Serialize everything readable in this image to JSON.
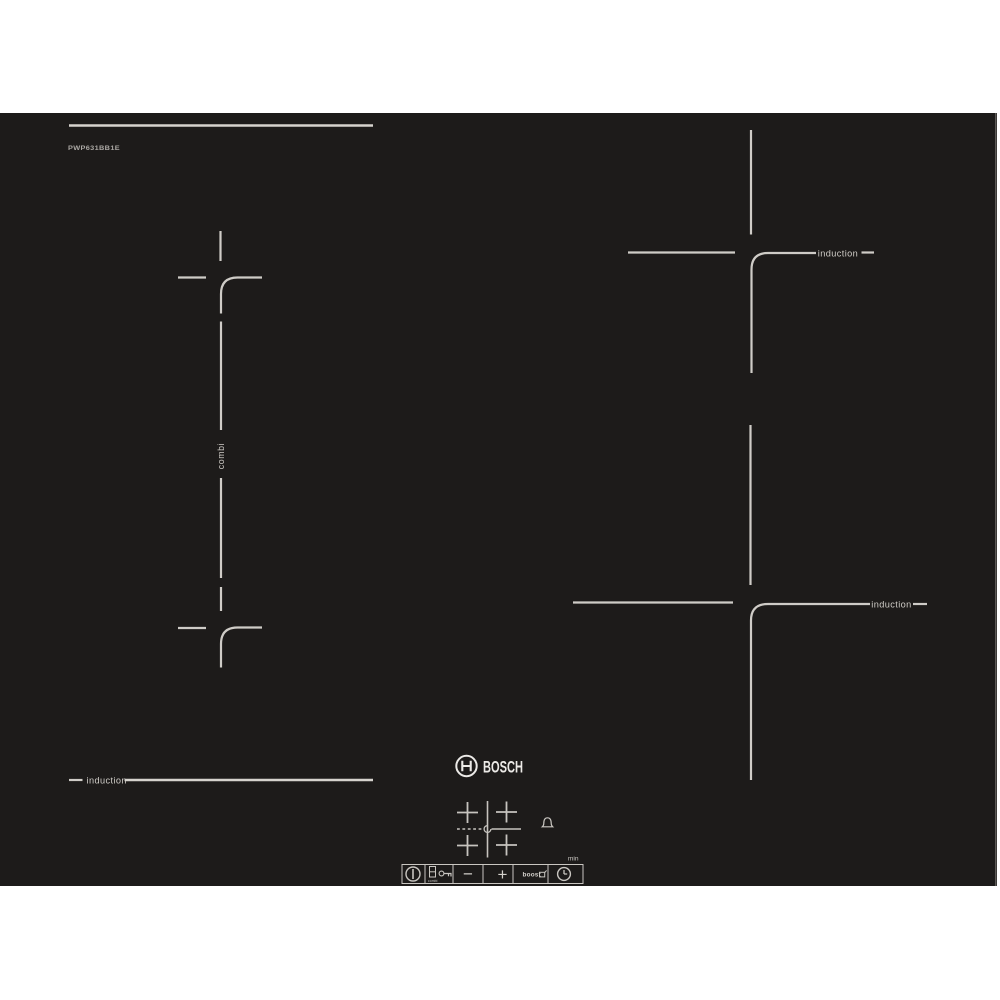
{
  "product": {
    "brand": "BOSCH",
    "model": "PWP631BB1E"
  },
  "zones": {
    "combi_label": "combi",
    "back_right_label": "induction",
    "front_right_label": "induction",
    "front_left_label": "induction"
  },
  "control_panel": {
    "min_label": "min",
    "alarm_icon": "alarm-bell-icon",
    "zone_map_icon": "zone-map-graphic",
    "buttons": [
      {
        "name": "power",
        "icon": "power-icon",
        "label": ""
      },
      {
        "name": "combi-select",
        "icon": "combi-zones-icon",
        "label": "combi"
      },
      {
        "name": "child-lock",
        "icon": "key-icon",
        "label": ""
      },
      {
        "name": "minus",
        "icon": "minus-glyph",
        "label": "−"
      },
      {
        "name": "plus",
        "icon": "plus-glyph",
        "label": "+"
      },
      {
        "name": "boost",
        "icon": "pan-boost-icon",
        "label": "boost"
      },
      {
        "name": "timer",
        "icon": "clock-icon",
        "label": ""
      }
    ]
  },
  "colors": {
    "background": "#ffffff",
    "hob_surface": "#1d1b1a",
    "markings": "#cfccc7",
    "logo": "#eceae7"
  }
}
